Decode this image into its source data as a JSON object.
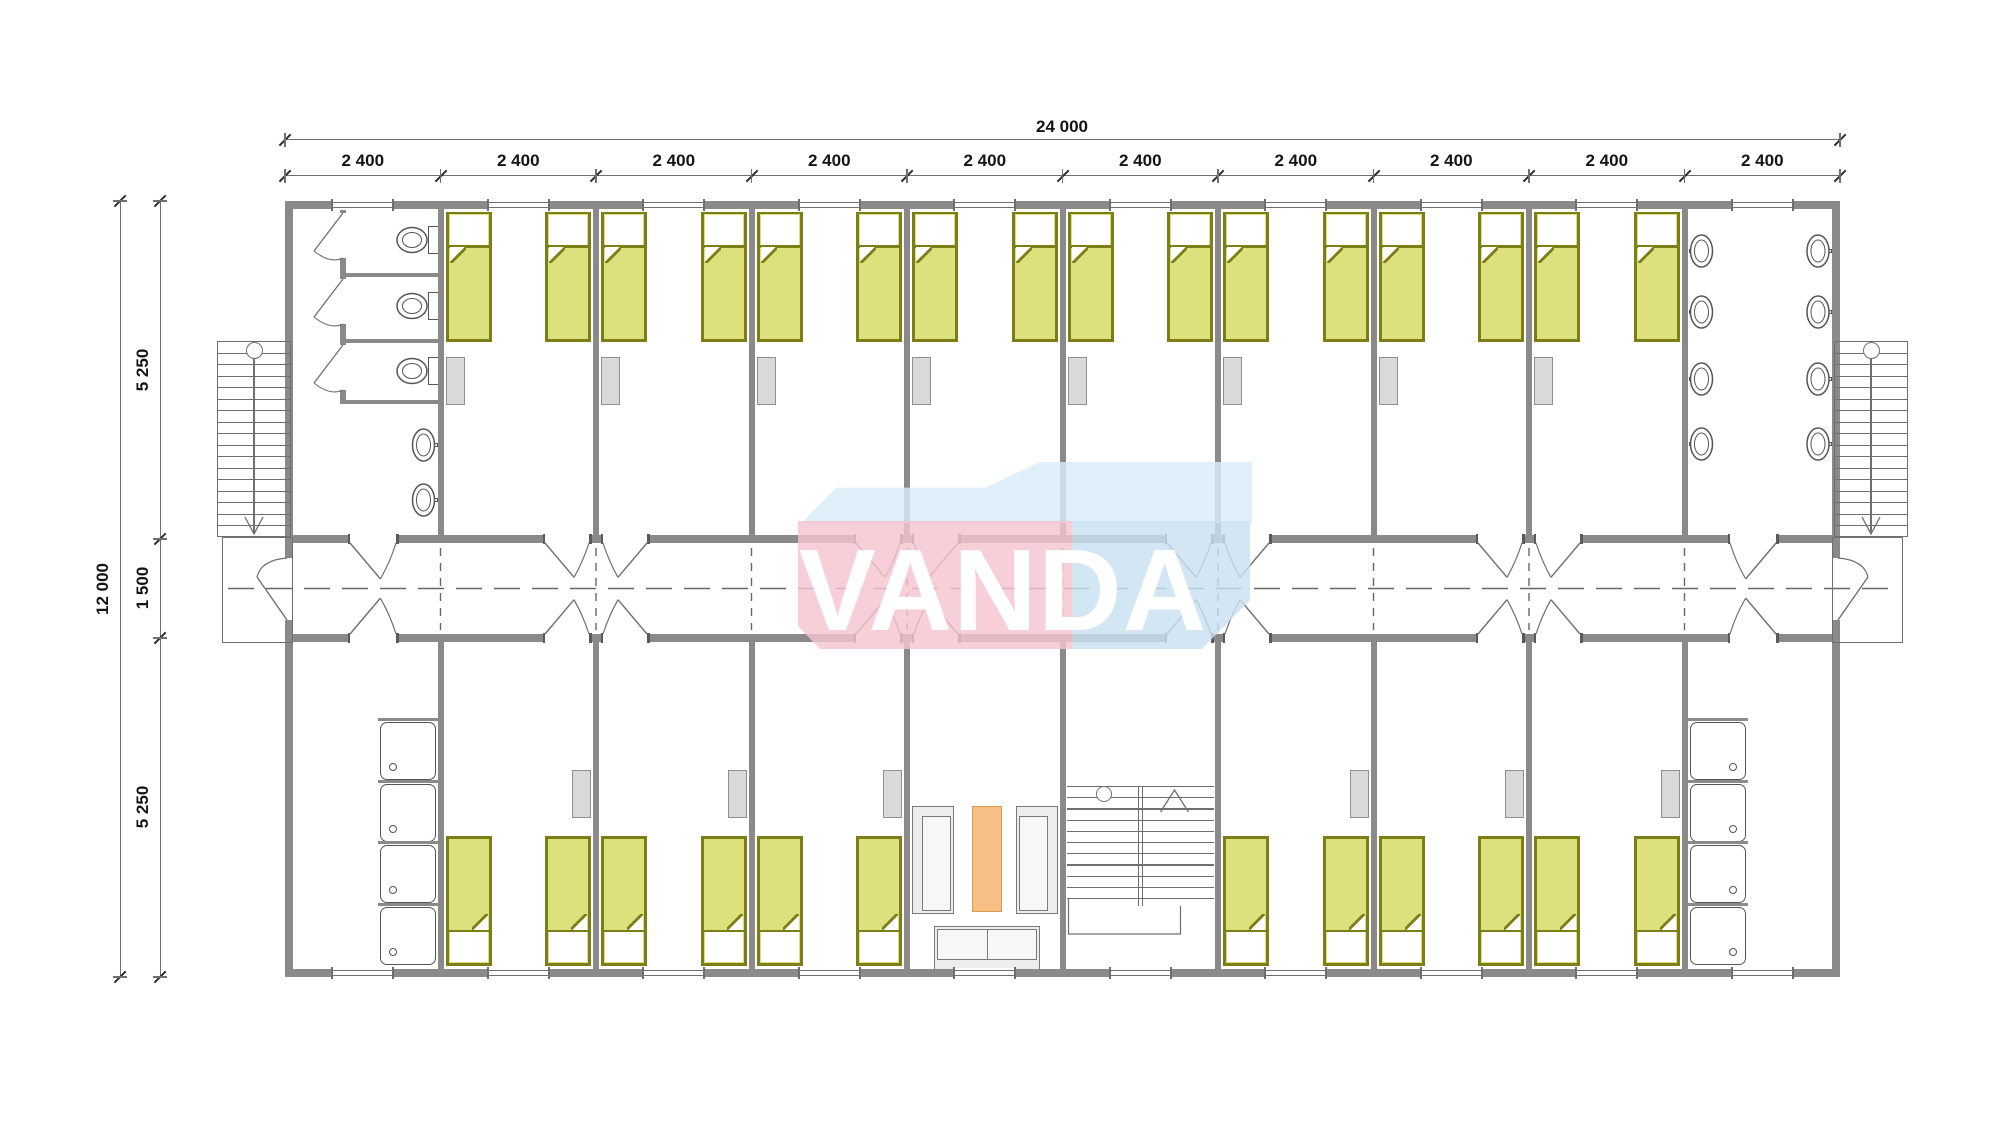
{
  "watermark": {
    "text": "VANDA",
    "text_color": "#ffffff",
    "pink_front": "#f4c5d0",
    "blue_front": "#c9e1f2",
    "blue_top": "#d9edf9"
  },
  "dimensions": {
    "top_total": "24 000",
    "top_segments": [
      "2 400",
      "2 400",
      "2 400",
      "2 400",
      "2 400",
      "2 400",
      "2 400",
      "2 400",
      "2 400",
      "2 400"
    ],
    "left_total": "12 000",
    "left_segments": [
      "5 250",
      "1 500",
      "5 250"
    ]
  },
  "colors": {
    "wall": "#8a8a8a",
    "thin_line": "#6f6f6f",
    "bed_fill": "#dde17d",
    "bed_border": "#7e7e16",
    "wardrobe_fill": "#d9d9d9",
    "wardrobe_border": "#8f8f8f",
    "table_fill": "#f6bf85",
    "table_border": "#d99a52",
    "sofa_fill": "#ededed",
    "sofa_border": "#7a7a7a",
    "fixture_line": "#555555",
    "dim_text": "#141414"
  },
  "plan": {
    "modules": 10,
    "top_rooms": [
      {
        "type": "toilet-room",
        "stalls": 3,
        "basins": 2
      },
      {
        "type": "bedroom",
        "beds": 2
      },
      {
        "type": "bedroom",
        "beds": 2
      },
      {
        "type": "bedroom",
        "beds": 2
      },
      {
        "type": "bedroom",
        "beds": 2
      },
      {
        "type": "bedroom",
        "beds": 2
      },
      {
        "type": "bedroom",
        "beds": 2
      },
      {
        "type": "bedroom",
        "beds": 2
      },
      {
        "type": "bedroom",
        "beds": 2
      },
      {
        "type": "washroom",
        "basins": 8
      }
    ],
    "bottom_rooms": [
      {
        "type": "shower-room",
        "showers": 4
      },
      {
        "type": "bedroom",
        "beds": 2
      },
      {
        "type": "bedroom",
        "beds": 2
      },
      {
        "type": "bedroom",
        "beds": 2
      },
      {
        "type": "lounge",
        "sofas": 3,
        "tables": 1
      },
      {
        "type": "stair-room"
      },
      {
        "type": "bedroom",
        "beds": 2
      },
      {
        "type": "bedroom",
        "beds": 2
      },
      {
        "type": "bedroom",
        "beds": 2
      },
      {
        "type": "shower-room",
        "showers": 4
      }
    ]
  }
}
